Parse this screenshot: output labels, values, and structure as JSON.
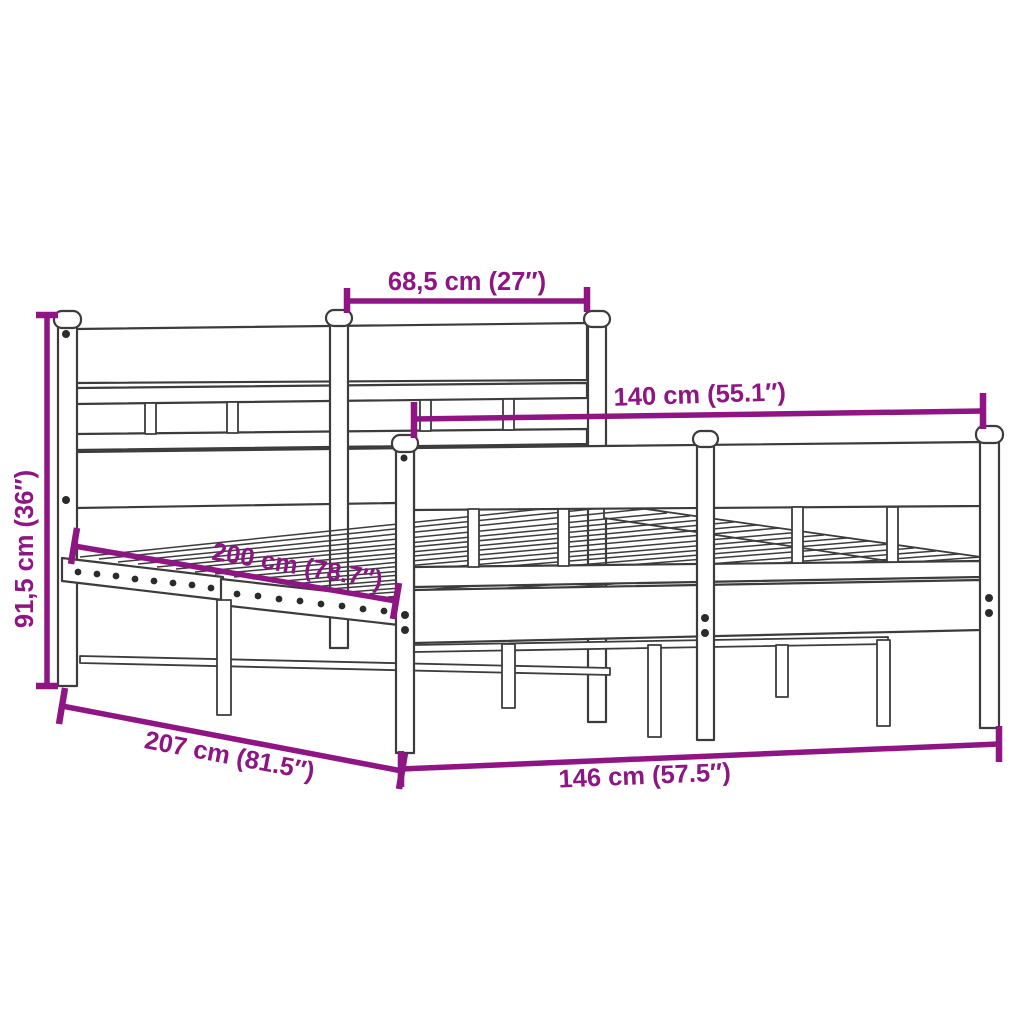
{
  "colors": {
    "accent": "#8E1583",
    "line": "#3C3C3C",
    "dot": "#2B2B2B",
    "background": "#FFFFFF"
  },
  "dimensions": {
    "headboard_section_width": {
      "label": "68,5 cm (27″)",
      "value_cm": "68,5",
      "value_in": "27"
    },
    "bed_width": {
      "label": "140 cm (55.1″)",
      "value_cm": "140",
      "value_in": "55.1"
    },
    "headboard_height": {
      "label": "91,5 cm (36″)",
      "value_cm": "91,5",
      "value_in": "36"
    },
    "bed_length": {
      "label": "200 cm (78.7″)",
      "value_cm": "200",
      "value_in": "78.7"
    },
    "frame_length": {
      "label": "207 cm (81.5″)",
      "value_cm": "207",
      "value_in": "81.5"
    },
    "frame_width": {
      "label": "146 cm (57.5″)",
      "value_cm": "146",
      "value_in": "57.5"
    }
  }
}
